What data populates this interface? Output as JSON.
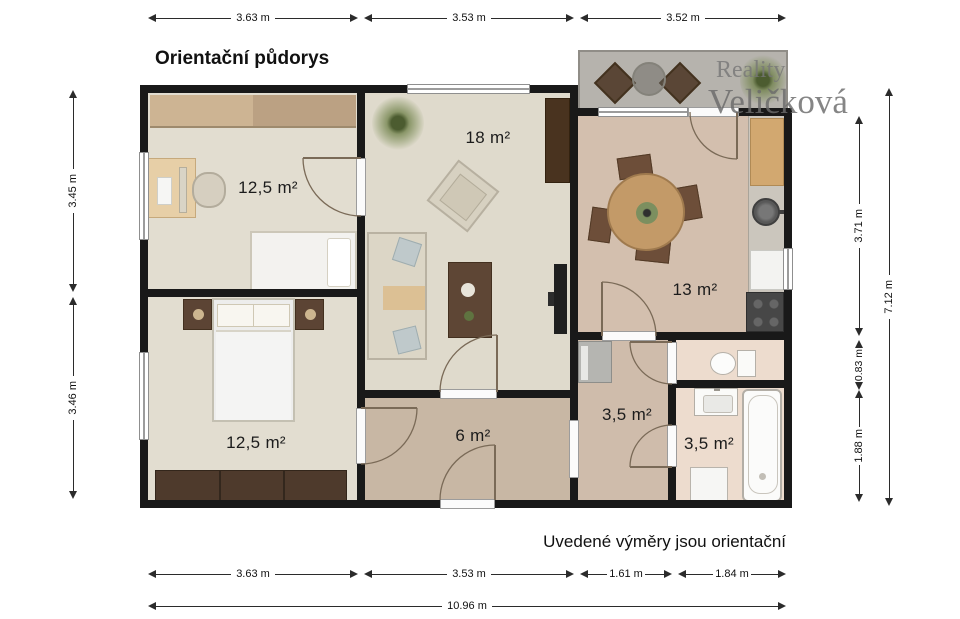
{
  "title": "Orientační půdorys",
  "watermark": {
    "line1": "Reality",
    "line2": "Veličková"
  },
  "disclaimer": "Uvedené výměry jsou orientační",
  "rooms": {
    "study": {
      "name": "study-bedroom",
      "area": "12,5 m²"
    },
    "living": {
      "name": "living-room",
      "area": "18 m²"
    },
    "kitchen": {
      "name": "kitchen-dining",
      "area": "13 m²"
    },
    "bedroom": {
      "name": "bedroom",
      "area": "12,5 m²"
    },
    "hall": {
      "name": "hallway",
      "area": "6 m²"
    },
    "hall_small": {
      "name": "small-hall",
      "area": "3,5 m²"
    },
    "bathroom": {
      "name": "bathroom",
      "area": "3,5 m²"
    }
  },
  "dims": {
    "top": [
      "3.63 m",
      "3.53 m",
      "3.52 m"
    ],
    "left": [
      "3.45 m",
      "3.46 m"
    ],
    "right": [
      "3.71 m",
      "0.83 m",
      "1.88 m"
    ],
    "right_total": "7.12 m",
    "bottom": [
      "3.63 m",
      "3.53 m",
      "1.61 m",
      "1.84 m"
    ],
    "bottom_total": "10.96 m"
  },
  "colors": {
    "wall": "#191919",
    "floor_rooms": "#e2ddd0",
    "floor_living": "#dfdacc",
    "floor_kitchen": "#d3bfae",
    "floor_hall": "#c8b7a4",
    "floor_bath": "#eddcce",
    "balcony": "#b6b3ad",
    "dimension_line": "#2b2b2b",
    "watermark_gray": "#6b6b6b"
  }
}
